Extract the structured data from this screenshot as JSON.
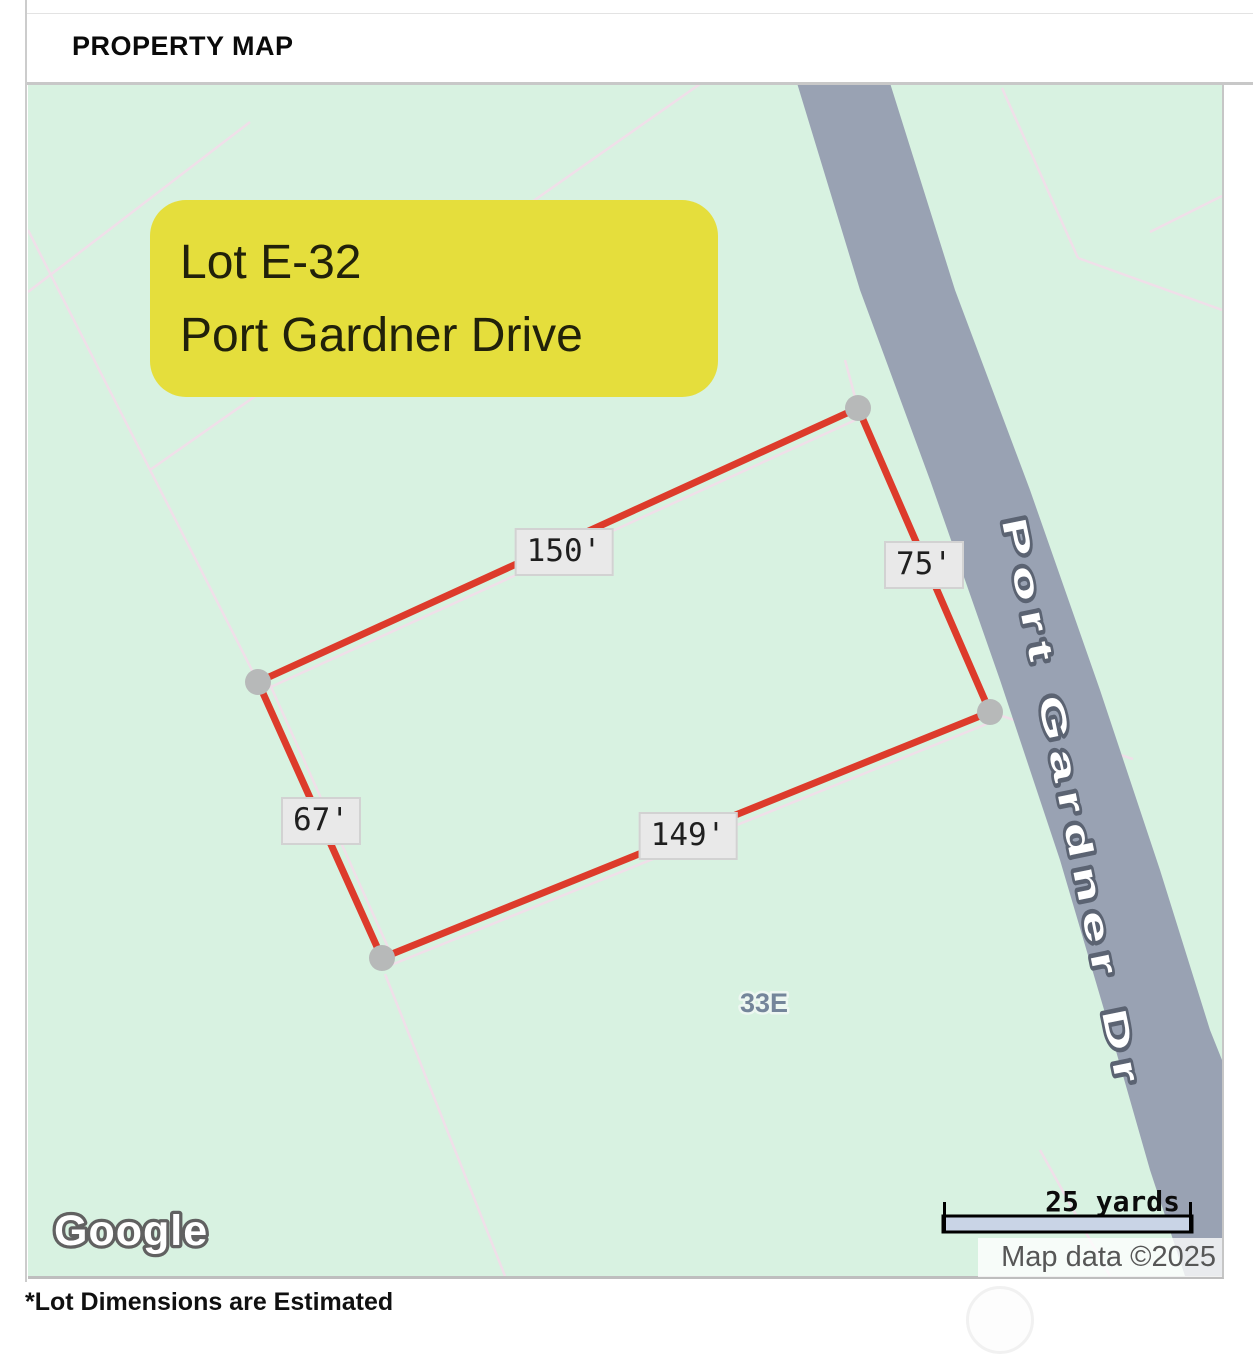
{
  "header": {
    "title": "PROPERTY MAP"
  },
  "callout": {
    "line1": "Lot E-32",
    "line2": "Port Gardner Drive",
    "bg_color": "#e5de3c"
  },
  "lot": {
    "outline_color": "#dd3b2b",
    "dimensions": [
      {
        "side": "northwest",
        "label": "150'"
      },
      {
        "side": "northeast",
        "label": "75'"
      },
      {
        "side": "southwest",
        "label": "67'"
      },
      {
        "side": "southeast",
        "label": "149'"
      }
    ],
    "parcel_label": "33E"
  },
  "map": {
    "road_name": "Port Gardner Dr",
    "road_color": "#99a2b3",
    "land_color": "#d8f2e1",
    "logo": "Google",
    "scale_label": "25 yards",
    "attribution": "Map data ©2025"
  },
  "footer": {
    "note": "*Lot Dimensions are Estimated"
  }
}
